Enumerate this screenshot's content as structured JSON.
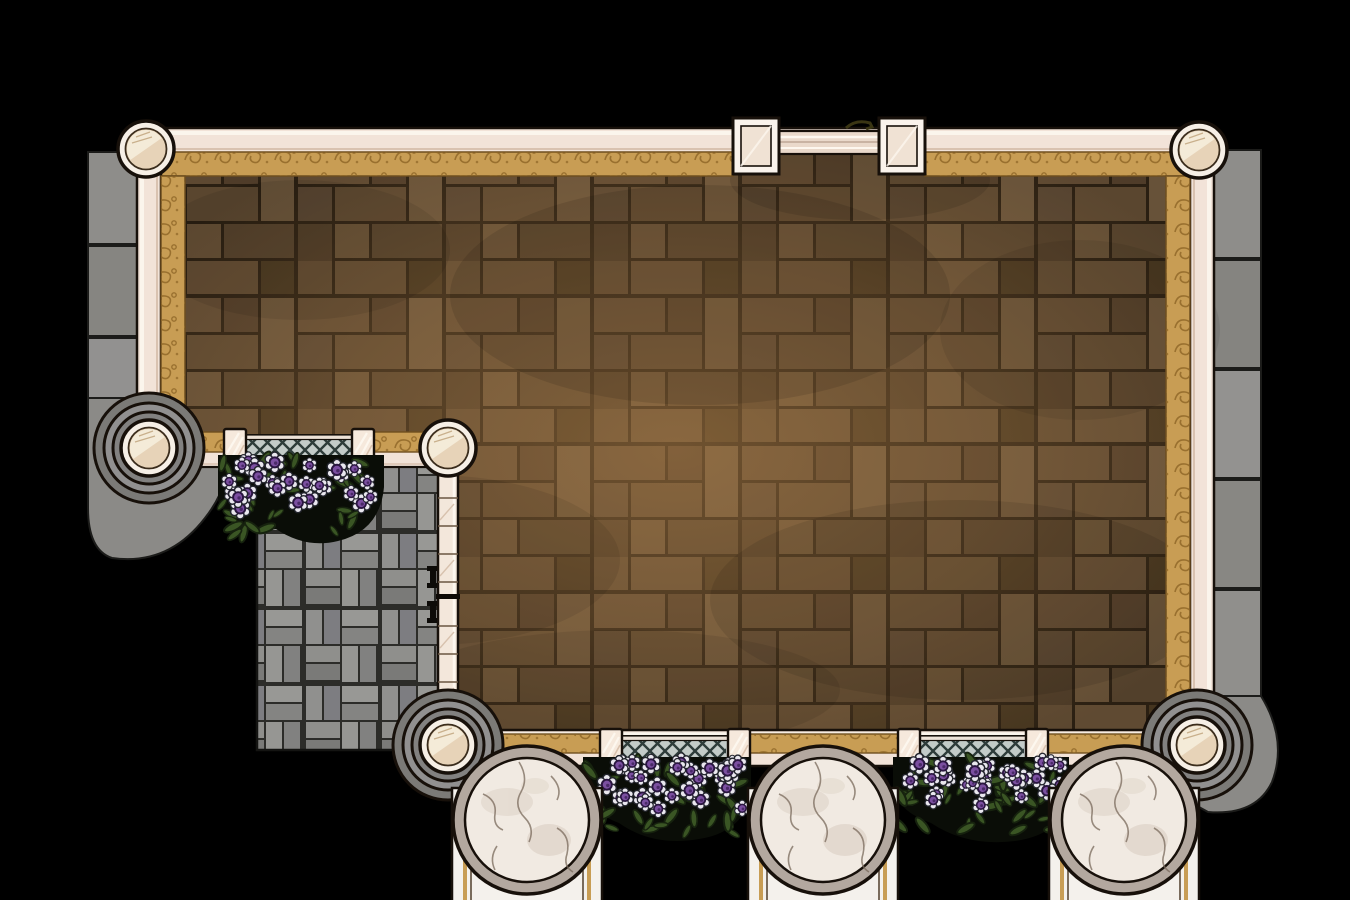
{
  "scene": {
    "kind": "top-down-battle-map",
    "setting": "walled courtyard terrace with stone path, flower beds and marble columns",
    "visible_text": "none"
  },
  "palette": {
    "background": "#000000",
    "wall_cream": "#f2e3d8",
    "wall_cream_dark": "#e3cbbb",
    "wall_highlight": "#fcf6ee",
    "wall_outline": "#17100a",
    "gold_trim": "#c89d54",
    "gold_trim_motif": "#8d6526",
    "gold_trim_edge": "#6e4e1f",
    "floor_brown": "#6b5336",
    "floor_grout": "#2a1f12",
    "floor_glow": "#b5854d",
    "stone_gray": "#8e8d8a",
    "stone_joint": "#2e2e2b",
    "path_gray": "#949492",
    "path_grout": "#2f2f2c",
    "lattice_bg": "#c3cbc8",
    "lattice_line": "#2e3c3a",
    "flower_purple": "#7b4fa0",
    "flower_purple_dark": "#2a1640",
    "flower_petal": "#e9e7ee",
    "leaf_green": "#3a5524",
    "leaf_outline": "#16220e",
    "bed_dark": "#0a0d07",
    "marble_light": "#f1eae2",
    "marble_ring": "#b3a89f",
    "marble_vein": "#7a6a5c",
    "pillar_cream": "#e7d3b8",
    "pillar_face": "#f6efe6",
    "base_white": "#f4f1ec",
    "door_dark": "#0e0a06"
  },
  "elements": {
    "round_pillars": 6,
    "square_gate_pillars": 2,
    "marble_columns": 3,
    "lattice_panels": 3,
    "fence_posts": 6,
    "flower_beds": 3,
    "gates": {
      "top_gate": "fluted gate between square pillars",
      "side_doors": "double door in plank fence"
    },
    "floors": [
      "brown parquet courtyard",
      "gray basket-weave path",
      "outer stone curb"
    ]
  },
  "flowerbeds": [
    {
      "x": 216,
      "y": 454,
      "w": 170,
      "h": 92,
      "n": 26,
      "seed": 7
    },
    {
      "x": 583,
      "y": 756,
      "w": 168,
      "h": 88,
      "n": 30,
      "seed": 13
    },
    {
      "x": 893,
      "y": 756,
      "w": 176,
      "h": 88,
      "n": 30,
      "seed": 29
    }
  ]
}
